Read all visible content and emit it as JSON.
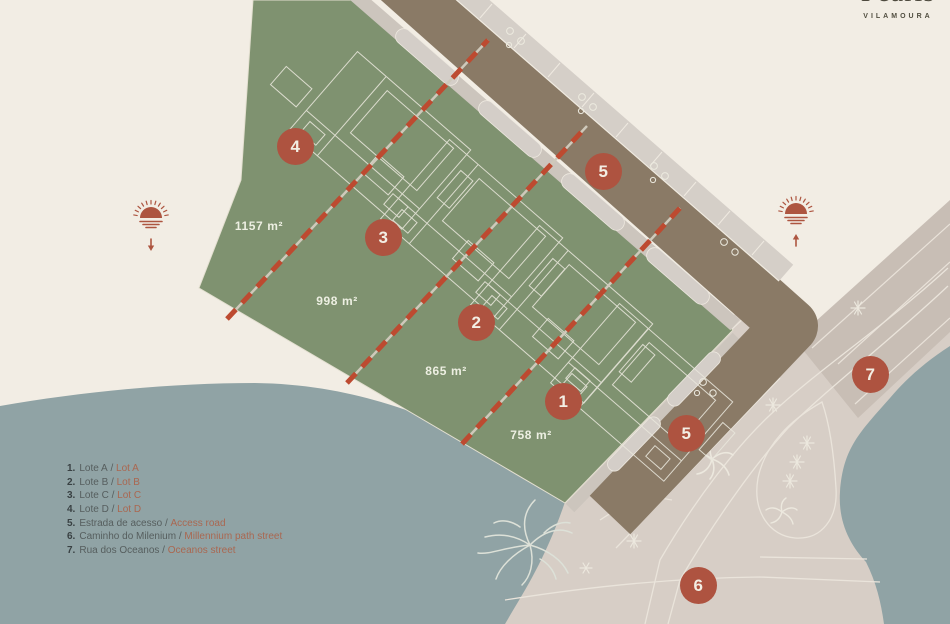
{
  "brand": {
    "name": "Pearls",
    "subtitle": "VILAMOURA"
  },
  "map": {
    "markers": [
      "4",
      "3",
      "2",
      "1",
      "5",
      "5",
      "6",
      "7"
    ],
    "area_labels": [
      "1157 m²",
      "998 m²",
      "865 m²",
      "758 m²"
    ]
  },
  "legend": {
    "items": [
      {
        "num": "1.",
        "pt": "Lote A",
        "sep": " / ",
        "en": "Lot A"
      },
      {
        "num": "2.",
        "pt": "Lote B",
        "sep": " / ",
        "en": "Lot B"
      },
      {
        "num": "3.",
        "pt": "Lote C",
        "sep": " / ",
        "en": "Lot C"
      },
      {
        "num": "4.",
        "pt": "Lote D",
        "sep": " / ",
        "en": "Lot D"
      },
      {
        "num": "5.",
        "pt": "Estrada de acesso",
        "sep": " / ",
        "en": "Access road"
      },
      {
        "num": "6.",
        "pt": "Caminho do Milenium",
        "sep": " / ",
        "en": "Millennium path street"
      },
      {
        "num": "7.",
        "pt": "Rua dos Oceanos",
        "sep": " / ",
        "en": "Oceanos street"
      }
    ]
  },
  "colors": {
    "terracotta": "#ae5340",
    "site_green": "#7f9270",
    "water": "#90a3a5",
    "access_road_brown": "#8a7a66",
    "pavement": "#d7cec6",
    "oceanos_road": "#c8beb5",
    "background_cream": "#f2ede4"
  }
}
